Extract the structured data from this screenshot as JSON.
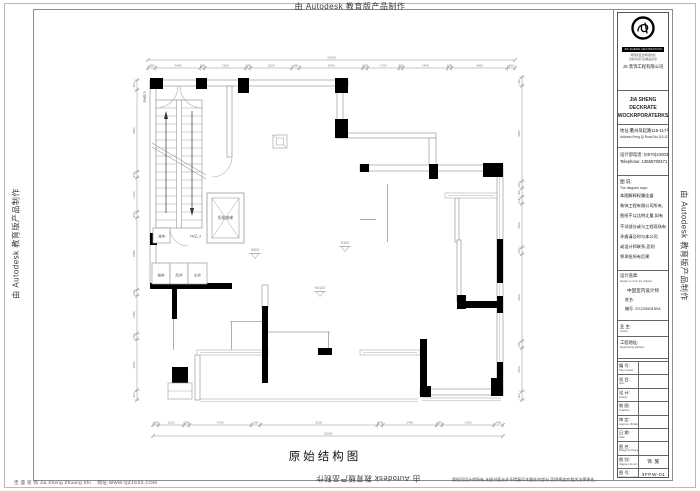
{
  "colors": {
    "wall": "#000000",
    "outline": "#9a9a9a",
    "dim_line": "#8f8f8f",
    "dim_text": "#7d7d7d",
    "frame": "#8c8c8c",
    "text": "#222222"
  },
  "banners": {
    "top": "由 Autodesk 教育版产品制作",
    "left": "由 Autodesk 教育版产品制作",
    "right": "由 Autodesk 教育版产品制作",
    "bottom": "由 Autodesk 教育版产品制作"
  },
  "footer": {
    "company": "佳 盛 装 饰 Jia Sheng Zhuang Shi",
    "site": "网址:WWW.QZJGZS.COM",
    "copyright": "版权归设计师所有,未经书面允许不得复印本图任何部分,否则将追究相关法律责任。"
  },
  "drawing": {
    "title": "原始结构图"
  },
  "plan": {
    "labels": {
      "elevator": "担架电梯",
      "shaft_strong": "强电",
      "shaft_wind": "风井",
      "shaft_water": "水井",
      "room_power": "强电",
      "door_top": "FM甲.3",
      "door_bottom": "FM乙.3",
      "level_a": "H300",
      "level_b": "H300",
      "level_c": "H3120"
    },
    "dimensions": {
      "top": {
        "total": "22396",
        "segments": [
          "400",
          "2400",
          "240",
          "2200",
          "240",
          "2220",
          "400",
          "3400",
          "240",
          "1700",
          "200",
          "2400",
          "200",
          "3000",
          "400"
        ]
      },
      "bottom": {
        "total": "22696",
        "segments": [
          "240",
          "1130",
          "240",
          "2750",
          "400",
          "5200",
          "240",
          "2400",
          "240",
          "2300",
          "400"
        ]
      },
      "left": {
        "segments": [
          "400",
          "3350",
          "240",
          "1400",
          "240",
          "2950",
          "240",
          "1550",
          "240",
          "2080",
          "400"
        ]
      },
      "right": {
        "segments": [
          "300",
          "3300",
          "240",
          "300",
          "240",
          "1500",
          "240",
          "3000",
          "240",
          "1500",
          "300"
        ]
      }
    }
  },
  "titleblock": {
    "logo": {
      "ring_caption": "JIA SHENG DECORATION",
      "slogan1": "特别的爱给特别的您",
      "slogan2": "真诚为您打造精品家居",
      "company_cn": "JS 装饰工程有限公司"
    },
    "company_en1": "JIA SHENG DECKRATE",
    "company_en2": "WOCKRPORATERKS",
    "address_cn": "地址:衢州凤起路115-117号",
    "address_en": "Address:Feng Qi Road No.115-117",
    "tel_cn": "设计部电话: (0570)2300388",
    "tel_en": "Telephone: 13655700471",
    "notes_title": "图 说:",
    "notes_title_en": "The diagram says:",
    "notes_lines": [
      "本图解释权属佳盛",
      "装饰工程有限公司所有,",
      "图纸不以比例丈量,如有",
      "不详部分或与工程现场有",
      "矛盾请及时与本公司",
      "或设计师联系,否则",
      "将承担所有后果."
    ],
    "seal_label": "设计盖章:",
    "seal_label_en": "Design to cover the chapter:",
    "seal_line1": "中国室内设计师",
    "seal_line2": "姓名:",
    "seal_line3": "编号: ZYZ20501904",
    "owner_label": "业 主:",
    "owner_label_en": "Owner:",
    "engaddr_label": "工程地址:",
    "engaddr_label_en": "Engineering address:",
    "rows": [
      {
        "cn": "编 号:",
        "en": "Part number:",
        "value": ""
      },
      {
        "cn": "项 目:",
        "en": "Item:",
        "value": ""
      },
      {
        "cn": "设 计:",
        "en": "Design:",
        "value": ""
      },
      {
        "cn": "制 图:",
        "en": "Graphics:",
        "value": ""
      },
      {
        "cn": "审 定:",
        "en": "Approve officially:",
        "value": ""
      },
      {
        "cn": "日 期:",
        "en": "Date:",
        "value": ""
      },
      {
        "cn": "图 名:",
        "en": "Design for Name:",
        "value": ""
      },
      {
        "cn": "图 别:",
        "en": "Diagram do not:",
        "value": "饰 施"
      },
      {
        "cn": "图 号:",
        "en": "Diagram number:",
        "value": "3FPW-01"
      }
    ]
  }
}
